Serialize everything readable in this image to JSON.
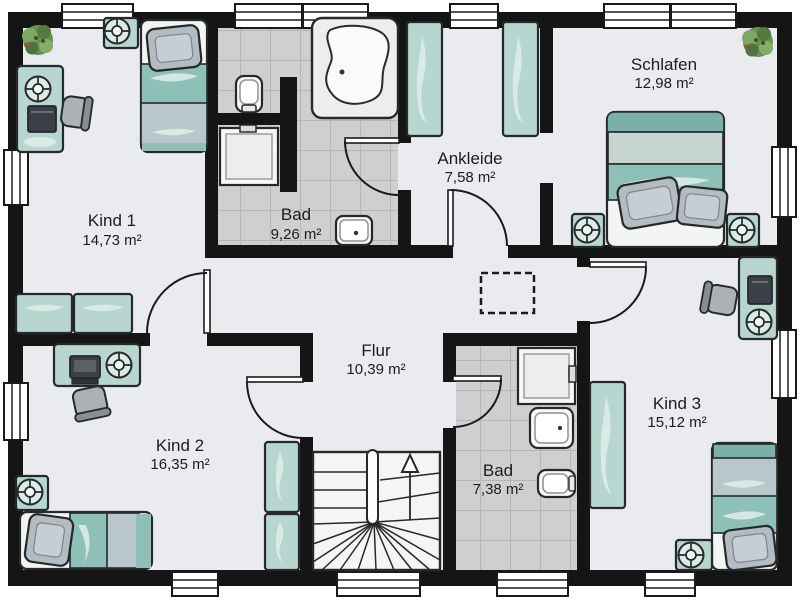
{
  "rooms": {
    "kind1": {
      "name": "Kind 1",
      "area": "14,73 m²"
    },
    "bad_top": {
      "name": "Bad",
      "area": "9,26 m²"
    },
    "ankleide": {
      "name": "Ankleide",
      "area": "7,58 m²"
    },
    "schlafen": {
      "name": "Schlafen",
      "area": "12,98 m²"
    },
    "flur": {
      "name": "Flur",
      "area": "10,39 m²"
    },
    "kind2": {
      "name": "Kind 2",
      "area": "16,35 m²"
    },
    "bad_bottom": {
      "name": "Bad",
      "area": "7,38 m²"
    },
    "kind3": {
      "name": "Kind 3",
      "area": "15,12 m²"
    }
  },
  "furniture": {
    "kind1": [
      "plant",
      "nightstand-lamp",
      "single-bed",
      "pillow",
      "desk",
      "desk-lamp",
      "laptop",
      "office-chair",
      "sideboard",
      "sideboard"
    ],
    "bad_top": [
      "corner-bathtub",
      "toilet",
      "shower",
      "washbasin"
    ],
    "ankleide": [
      "wardrobe",
      "wardrobe"
    ],
    "schlafen": [
      "plant",
      "double-bed",
      "pillow",
      "pillow",
      "nightstand-lamp",
      "nightstand-lamp"
    ],
    "flur": [
      "dashed-ceiling-opening"
    ],
    "stairs": [
      "u-shaped-staircase",
      "up-arrow"
    ],
    "kind2": [
      "desk",
      "computer",
      "desk-lamp",
      "office-chair",
      "nightstand-lamp",
      "single-bed",
      "pillow",
      "wardrobe",
      "wardrobe"
    ],
    "bad_bottom": [
      "shower",
      "washbasin",
      "toilet"
    ],
    "kind3": [
      "desk",
      "laptop",
      "desk-lamp",
      "office-chair",
      "wardrobe",
      "single-bed",
      "pillow",
      "nightstand-lamp"
    ]
  },
  "colors": {
    "wall": "#151515",
    "floor": "#e9ebee",
    "tile": "#cdcfd1",
    "tile_grid": "#b4b6b8",
    "furniture_green": "#b7d6cf",
    "blanket_teal": "#8fc0b8",
    "blanket_gray": "#b9c6cb",
    "pillow_gray": "#b3bcc3",
    "plant_green": "#6a9153",
    "fixture_white": "#f7f7f7",
    "outline": "#26282a"
  }
}
